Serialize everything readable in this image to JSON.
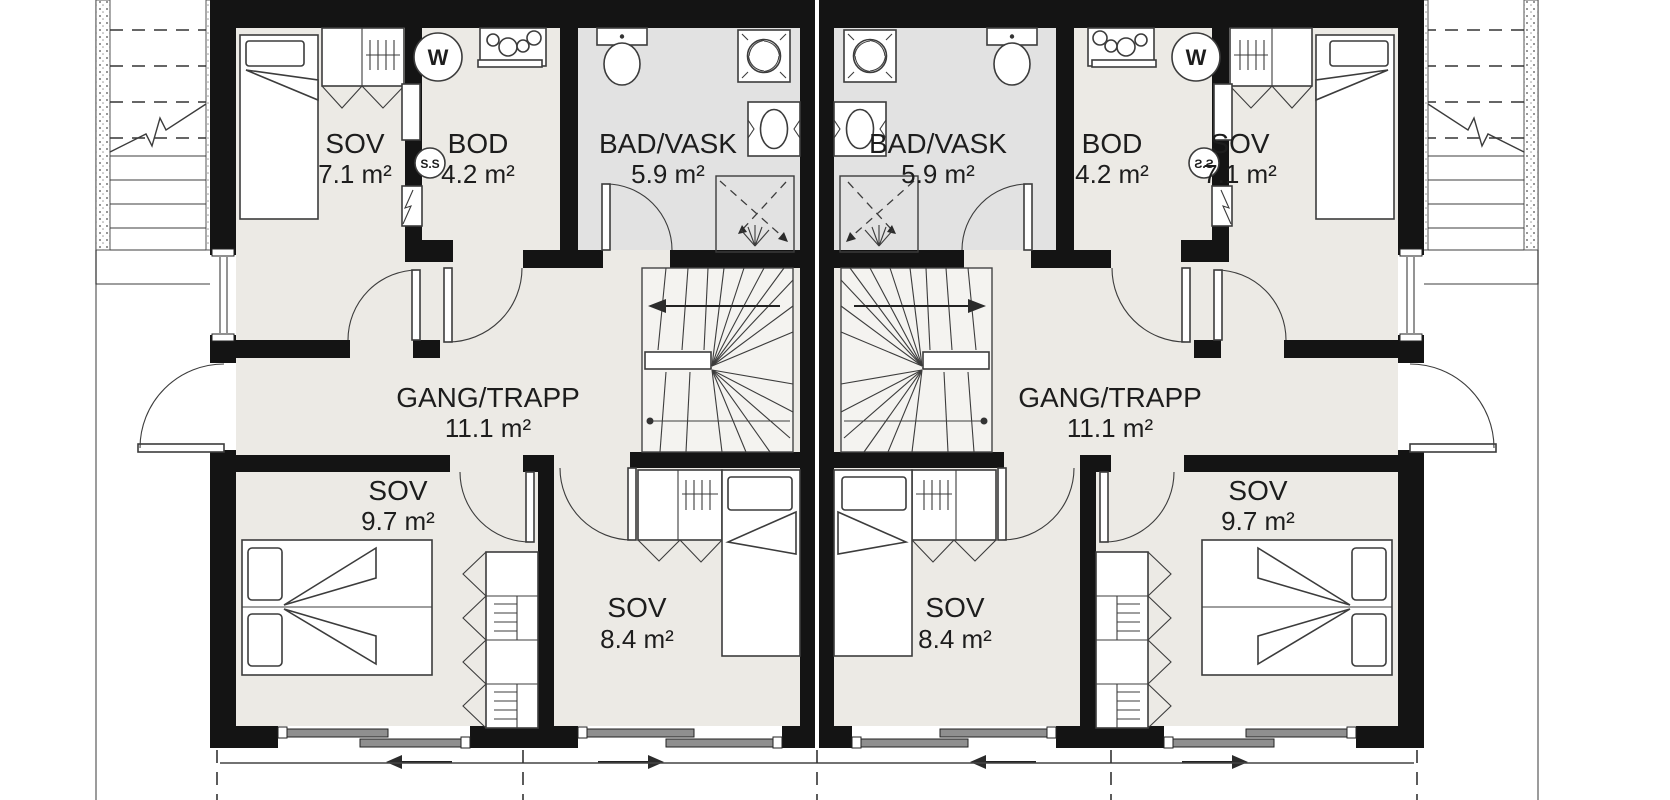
{
  "colors": {
    "wall": "#141414",
    "room_floor": "#ECEAE5",
    "bath_floor": "#E2E2E2",
    "stair_fill": "#F4F3F0",
    "window_glass": "#8F8F8F",
    "text": "#1D1D1D"
  },
  "rooms": {
    "left": {
      "sov_top": {
        "name": "SOV",
        "area": "7.1 m²"
      },
      "bod": {
        "name": "BOD",
        "area": "4.2 m²"
      },
      "bad": {
        "name": "BAD/VASK",
        "area": "5.9 m²"
      },
      "gang": {
        "name": "GANG/TRAPP",
        "area": "11.1 m²"
      },
      "sov_bottom": {
        "name": "SOV",
        "area": "9.7 m²"
      },
      "sov_mid": {
        "name": "SOV",
        "area": "8.4 m²"
      }
    },
    "right": {
      "sov_top": {
        "name": "SOV",
        "area": "7.1 m²"
      },
      "bod": {
        "name": "BOD",
        "area": "4.2 m²"
      },
      "bad": {
        "name": "BAD/VASK",
        "area": "5.9 m²"
      },
      "gang": {
        "name": "GANG/TRAPP",
        "area": "11.1 m²"
      },
      "sov_bottom": {
        "name": "SOV",
        "area": "9.7 m²"
      },
      "sov_mid": {
        "name": "SOV",
        "area": "8.4 m²"
      }
    }
  },
  "symbols": {
    "washing_machine": "W",
    "ss_cabinet": "S.S"
  }
}
